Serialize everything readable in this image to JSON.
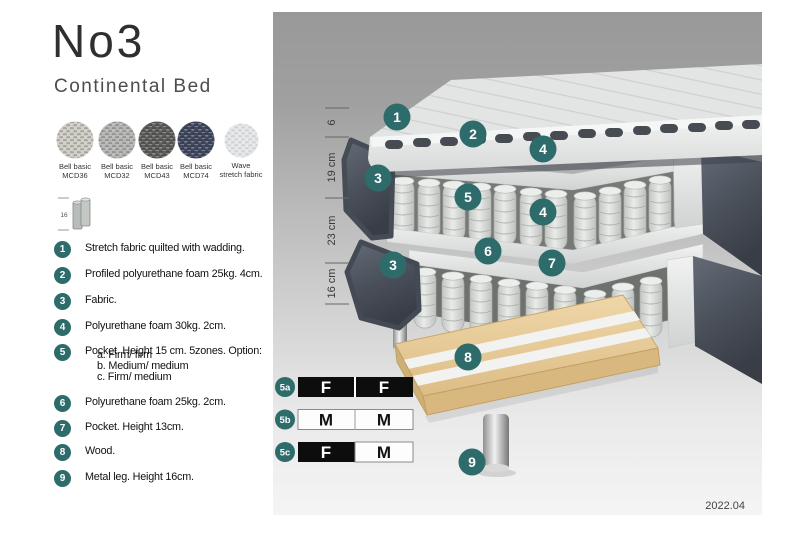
{
  "header": {
    "title": "No3",
    "subtitle": "Continental Bed"
  },
  "swatches": [
    {
      "line1": "Bell basic",
      "line2": "MCD36",
      "color": "#d2d0c7"
    },
    {
      "line1": "Bell basic",
      "line2": "MCD32",
      "color": "#b7b8b5"
    },
    {
      "line1": "Bell basic",
      "line2": "MCD43",
      "color": "#5d5f5c"
    },
    {
      "line1": "Bell basic",
      "line2": "MCD74",
      "color": "#414961"
    },
    {
      "line1": "Wave",
      "line2": "stretch fabric",
      "color": "#e7e9ec"
    }
  ],
  "leg_icon": {
    "height_label": "16"
  },
  "legend": [
    {
      "num": "1",
      "text": "Stretch fabric quilted with wadding."
    },
    {
      "num": "2",
      "text": "Profiled polyurethane foam 25kg. 4cm."
    },
    {
      "num": "3",
      "text": "Fabric."
    },
    {
      "num": "4",
      "text": "Polyurethane foam 30kg. 2cm."
    },
    {
      "num": "5",
      "text": "Pocket. Height 15 cm. 5zones. Option:",
      "options": [
        "a. Firm/ firm",
        "b. Medium/ medium",
        "c. Firm/ medium"
      ]
    },
    {
      "num": "6",
      "text": "Polyurethane foam 25kg. 2cm."
    },
    {
      "num": "7",
      "text": "Pocket. Height 13cm."
    },
    {
      "num": "8",
      "text": "Wood."
    },
    {
      "num": "9",
      "text": "Metal leg. Height 16cm."
    }
  ],
  "dimensions": {
    "mattress": "6",
    "upper_box": "19 cm",
    "lower_box": "23 cm",
    "legs": "16 cm"
  },
  "diagram_markers": [
    "1",
    "2",
    "4",
    "3",
    "5",
    "4",
    "6",
    "7",
    "3",
    "8",
    "9"
  ],
  "firmness": {
    "rows": [
      {
        "id": "5a",
        "left": {
          "letter": "F",
          "variant": "dark"
        },
        "right": {
          "letter": "F",
          "variant": "dark"
        }
      },
      {
        "id": "5b",
        "left": {
          "letter": "M",
          "variant": "light"
        },
        "right": {
          "letter": "M",
          "variant": "light"
        }
      },
      {
        "id": "5c",
        "left": {
          "letter": "F",
          "variant": "dark"
        },
        "right": {
          "letter": "M",
          "variant": "light"
        }
      }
    ]
  },
  "version": "2022.04",
  "colors": {
    "accent": "#2E6B6B",
    "fabric_dark": "#4E5560",
    "wood": "#E7CB97",
    "spring": "#D9DBD8",
    "background_top": "#9B9B9B",
    "background_bottom": "#F5F5F5"
  }
}
